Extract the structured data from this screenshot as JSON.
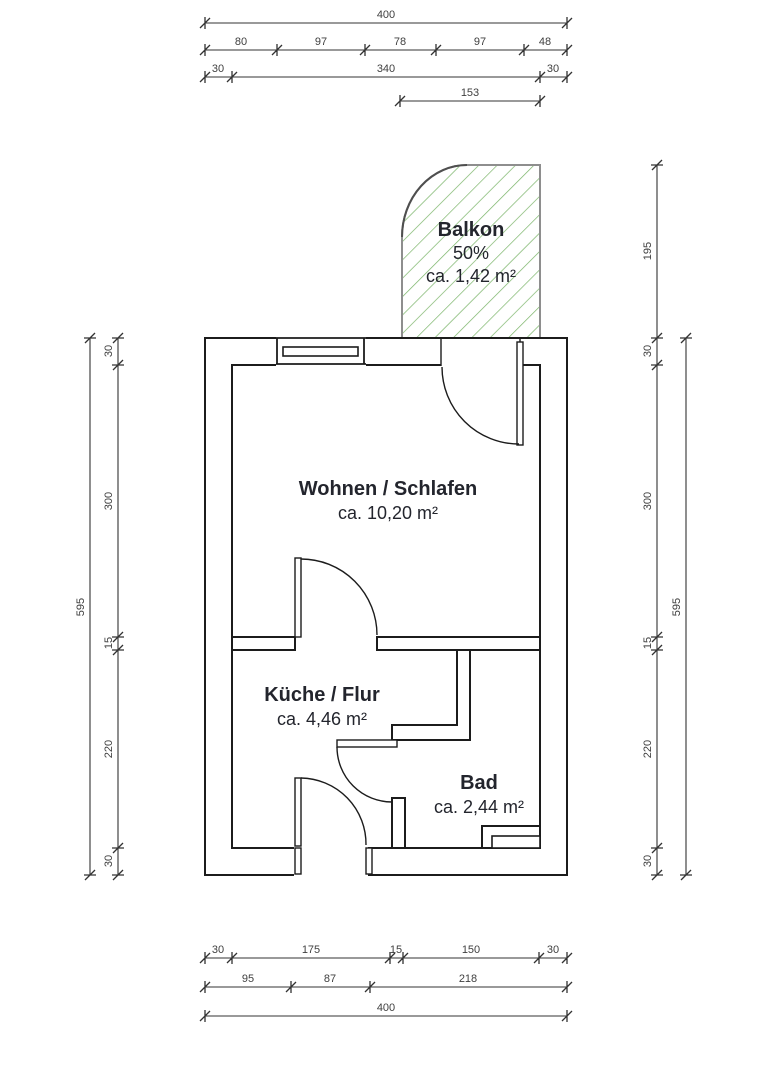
{
  "drawing": {
    "kind": "apartment-floor-plan"
  },
  "rooms": {
    "balkon": {
      "name": "Balkon",
      "share": "50%",
      "area": "ca. 1,42 m²"
    },
    "wohnen_schlafen": {
      "name": "Wohnen / Schlafen",
      "area": "ca. 10,20 m²"
    },
    "kueche_flur": {
      "name": "Küche / Flur",
      "area": "ca. 4,46 m²"
    },
    "bad": {
      "name": "Bad",
      "area": "ca. 2,44 m²"
    }
  },
  "dimensions": {
    "top": {
      "total": "400",
      "segments_row2": [
        "80",
        "97",
        "78",
        "97",
        "48"
      ],
      "segments_row3": [
        "30",
        "340",
        "30"
      ],
      "balcony_width": "153"
    },
    "bottom": {
      "segments_row1": [
        "30",
        "175",
        "15",
        "150",
        "30"
      ],
      "segments_row2": [
        "95",
        "87",
        "218"
      ],
      "total": "400"
    },
    "left": {
      "total": "595",
      "segments": [
        "30",
        "300",
        "15",
        "220",
        "30"
      ]
    },
    "right": {
      "balcony_height": "195",
      "segments": [
        "30",
        "300",
        "15",
        "220",
        "30"
      ],
      "total": "595"
    }
  },
  "colors": {
    "background": "#ffffff",
    "wall_line": "#1c1c1c",
    "dimension_line": "#333333",
    "dimension_text": "#3f3f3f",
    "room_text": "#23252d",
    "balcony_border": "#8e8e8e",
    "balcony_hatch": "#7ab468"
  }
}
